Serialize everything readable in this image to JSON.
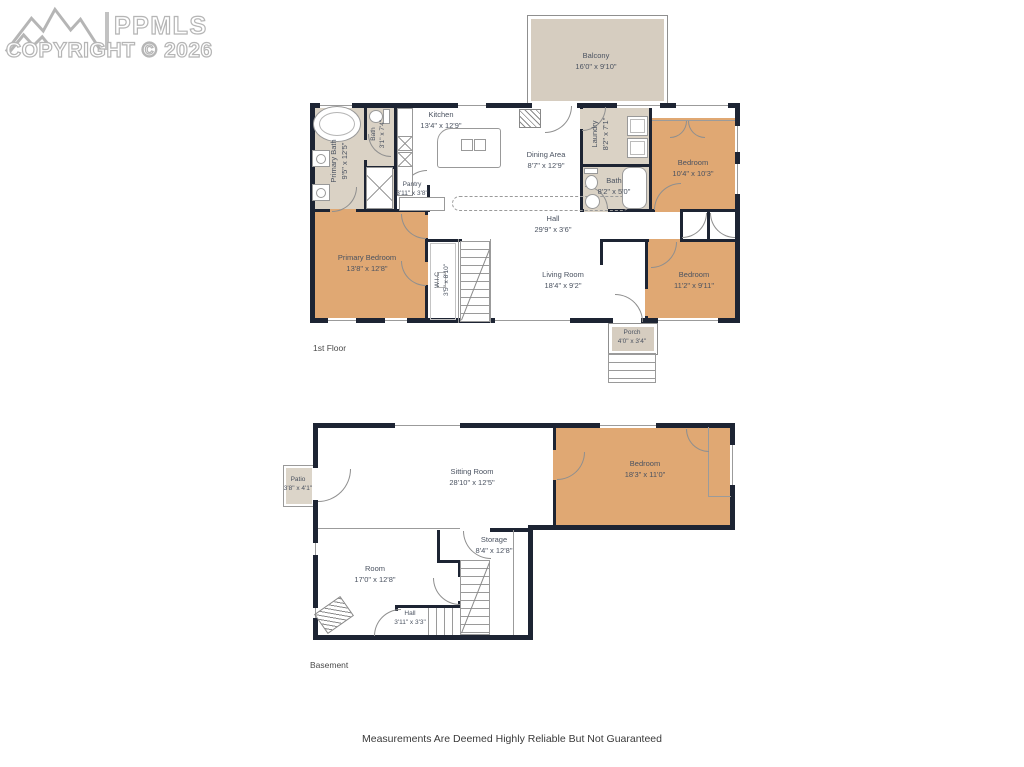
{
  "watermark": {
    "brand": "PPMLS",
    "copyright": "COPYRIGHT © 2026"
  },
  "footer": {
    "disclaimer": "Measurements Are Deemed Highly Reliable But Not Guaranteed"
  },
  "colors": {
    "wall": "#1d2433",
    "bedroom_fill": "#e0a873",
    "bath_fill": "#dad2c5",
    "outdoor_fill": "#d6cdc0",
    "label_text": "#4a5260"
  },
  "floor1": {
    "label": "1st Floor",
    "rooms": {
      "balcony": {
        "name": "Balcony",
        "dims": "16'0\" x 9'10\""
      },
      "kitchen": {
        "name": "Kitchen",
        "dims": "13'4\" x 12'9\""
      },
      "dining": {
        "name": "Dining Area",
        "dims": "8'7\" x 12'9\""
      },
      "laundry": {
        "name": "Laundry",
        "dims": "8'2\" x 7'1\""
      },
      "bath_upper": {
        "name": "Bath",
        "dims": "8'2\" x 5'0\""
      },
      "bedroom_tr": {
        "name": "Bedroom",
        "dims": "10'4\" x 10'3\""
      },
      "primary_bath": {
        "name": "Primary Bath",
        "dims": "9'5\" x 12'5\""
      },
      "bath_small": {
        "name": "Bath",
        "dims": "3'1\" x 7'4\""
      },
      "pantry": {
        "name": "Pantry",
        "dims": "3'11\" x 3'8\""
      },
      "hall": {
        "name": "Hall",
        "dims": "29'9\" x 3'6\""
      },
      "primary_bedroom": {
        "name": "Primary Bedroom",
        "dims": "13'8\" x 12'8\""
      },
      "wic": {
        "name": "W.I.C",
        "dims": "3'5\" x 8'10\""
      },
      "living": {
        "name": "Living Room",
        "dims": "18'4\" x 9'2\""
      },
      "bedroom_br": {
        "name": "Bedroom",
        "dims": "11'2\" x 9'11\""
      },
      "porch": {
        "name": "Porch",
        "dims": "4'0\" x 3'4\""
      }
    }
  },
  "basement": {
    "label": "Basement",
    "rooms": {
      "sitting": {
        "name": "Sitting Room",
        "dims": "28'10\" x 12'5\""
      },
      "bedroom": {
        "name": "Bedroom",
        "dims": "18'3\" x 11'0\""
      },
      "patio": {
        "name": "Patio",
        "dims": "3'8\" x 4'1\""
      },
      "room": {
        "name": "Room",
        "dims": "17'0\" x 12'8\""
      },
      "storage": {
        "name": "Storage",
        "dims": "8'4\" x 12'8\""
      },
      "hall": {
        "name": "Hall",
        "dims": "3'11\" x 3'3\""
      }
    }
  }
}
